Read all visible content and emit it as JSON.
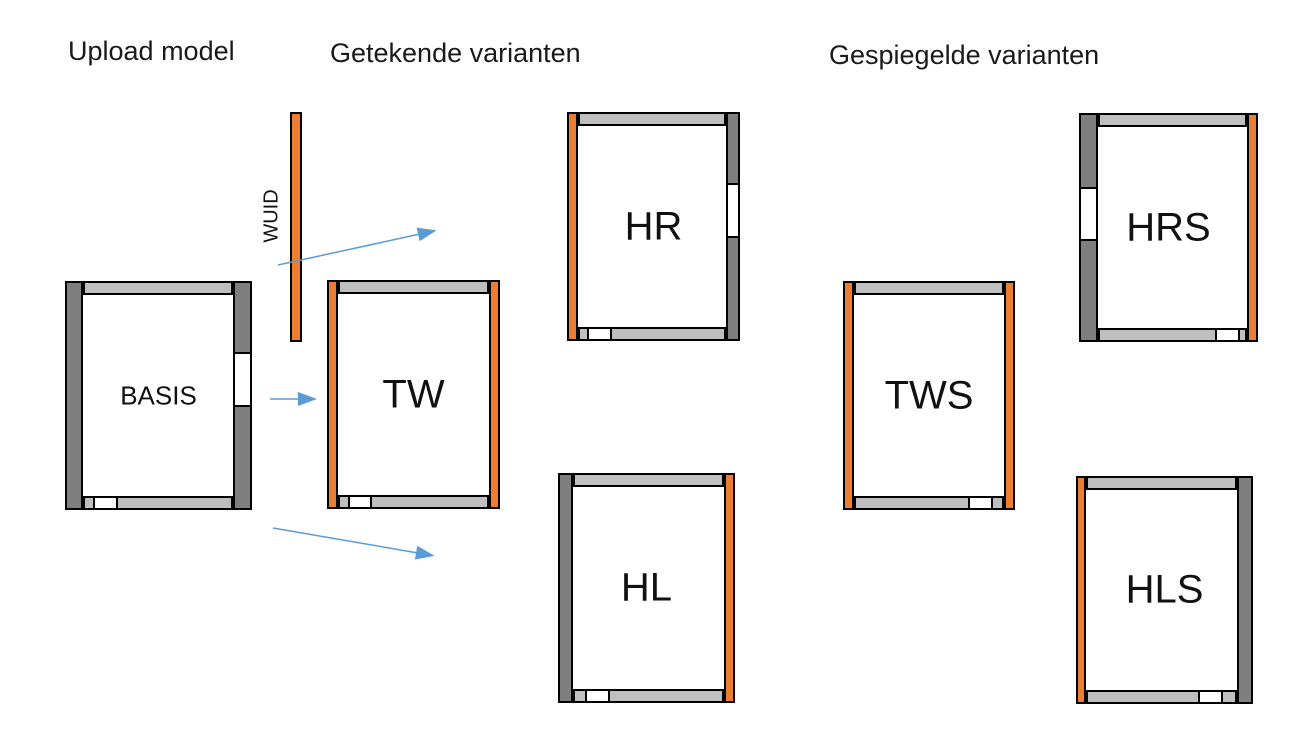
{
  "colors": {
    "orange": "#ED7D31",
    "dark_gray": "#7F7F7F",
    "light_gray": "#BFBFBF",
    "arrow_blue": "#5B9BD5",
    "outline": "#000000"
  },
  "headers": [
    {
      "label": "Upload model",
      "x": 68,
      "y": 36
    },
    {
      "label": "Getekende varianten",
      "x": 330,
      "y": 38
    },
    {
      "label": "Gespiegelde varianten",
      "x": 829,
      "y": 40
    }
  ],
  "wuid": {
    "label": "WUID"
  },
  "plans": [
    {
      "id": "basis",
      "label": "BASIS",
      "font": 26,
      "x": 65,
      "y": 281,
      "w": 187,
      "h": 229,
      "left": {
        "color": "dark",
        "w": 18
      },
      "right": {
        "color": "dark",
        "w": 19,
        "window": {
          "top": 71,
          "h": 55
        }
      },
      "top_h": 14,
      "bottom": {
        "h": 14,
        "gap": {
          "x": 28,
          "w": 25
        }
      }
    },
    {
      "id": "tw",
      "label": "TW",
      "font": 40,
      "x": 327,
      "y": 280,
      "w": 173,
      "h": 229,
      "left": {
        "color": "orange",
        "w": 11
      },
      "right": {
        "color": "orange",
        "w": 11
      },
      "top_h": 14,
      "bottom": {
        "h": 14,
        "gap": {
          "x": 21,
          "w": 24
        }
      }
    },
    {
      "id": "hr",
      "label": "HR",
      "font": 40,
      "x": 567,
      "y": 112,
      "w": 173,
      "h": 229,
      "left": {
        "color": "orange",
        "w": 11
      },
      "right": {
        "color": "dark",
        "w": 14,
        "window": {
          "top": 71,
          "h": 55
        }
      },
      "top_h": 14,
      "bottom": {
        "h": 14,
        "gap": {
          "x": 20,
          "w": 25
        }
      }
    },
    {
      "id": "hl",
      "label": "HL",
      "font": 40,
      "x": 558,
      "y": 473,
      "w": 177,
      "h": 230,
      "left": {
        "color": "dark",
        "w": 15
      },
      "right": {
        "color": "orange",
        "w": 11
      },
      "top_h": 14,
      "bottom": {
        "h": 14,
        "gap": {
          "x": 27,
          "w": 25
        }
      }
    },
    {
      "id": "tws",
      "label": "TWS",
      "font": 40,
      "x": 843,
      "y": 281,
      "w": 172,
      "h": 229,
      "left": {
        "color": "orange",
        "w": 11
      },
      "right": {
        "color": "orange",
        "w": 11
      },
      "top_h": 14,
      "bottom": {
        "h": 14,
        "gap": {
          "x": 125,
          "w": 25
        }
      }
    },
    {
      "id": "hrs",
      "label": "HRS",
      "font": 40,
      "x": 1079,
      "y": 113,
      "w": 179,
      "h": 229,
      "left": {
        "color": "dark",
        "w": 19,
        "window": {
          "top": 74,
          "h": 54
        }
      },
      "right": {
        "color": "orange",
        "w": 11
      },
      "top_h": 14,
      "bottom": {
        "h": 14,
        "gap": {
          "x": 136,
          "w": 25
        }
      }
    },
    {
      "id": "hls",
      "label": "HLS",
      "font": 40,
      "x": 1076,
      "y": 476,
      "w": 177,
      "h": 228,
      "left": {
        "color": "orange",
        "w": 10
      },
      "right": {
        "color": "dark",
        "w": 16
      },
      "top_h": 14,
      "bottom": {
        "h": 14,
        "gap": {
          "x": 122,
          "w": 25
        }
      }
    }
  ],
  "arrows": [
    {
      "x1": 278,
      "y1": 265,
      "x2": 420,
      "y2": 234
    },
    {
      "x1": 270,
      "y1": 399,
      "x2": 300,
      "y2": 399
    },
    {
      "x1": 273,
      "y1": 528,
      "x2": 418,
      "y2": 553
    }
  ]
}
